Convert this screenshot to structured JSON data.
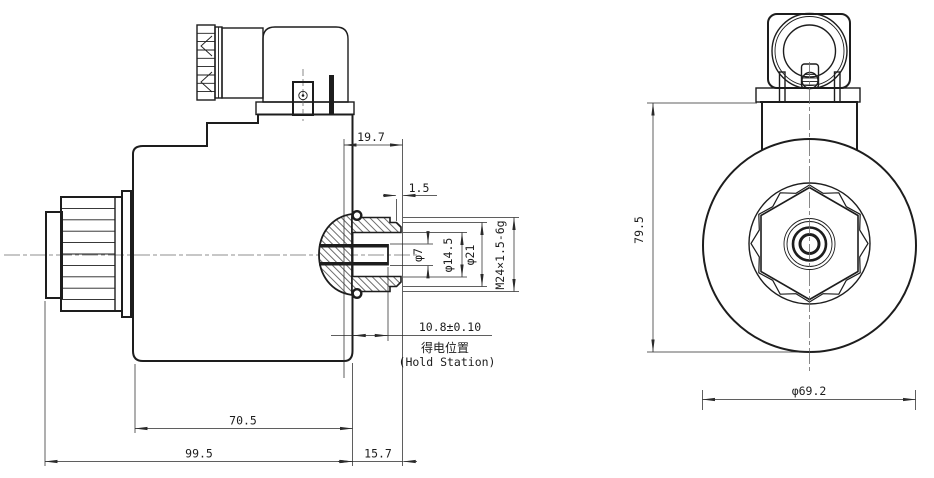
{
  "drawing": {
    "side_view": {
      "dimensions": {
        "tube_protrusion": "19.7",
        "tip_chamfer": "1.5",
        "pin_diameter": "φ7",
        "bore_diameter": "φ14.5",
        "tip_diameter": "φ21",
        "thread_spec": "M24×1.5-6g",
        "stroke_position": "10.8±0.10",
        "coil_length": "70.5",
        "total_length": "99.5",
        "tube_length": "15.7"
      },
      "annotations": {
        "hold_station_cn": "得电位置",
        "hold_station_en": "(Hold Station)"
      }
    },
    "front_view": {
      "dimensions": {
        "body_height": "79.5",
        "body_diameter": "φ69.2"
      }
    },
    "colors": {
      "line": "#1d1d1d",
      "dimension": "#2a2a2a",
      "centerline": "#6b6b6b",
      "background": "#ffffff"
    }
  }
}
